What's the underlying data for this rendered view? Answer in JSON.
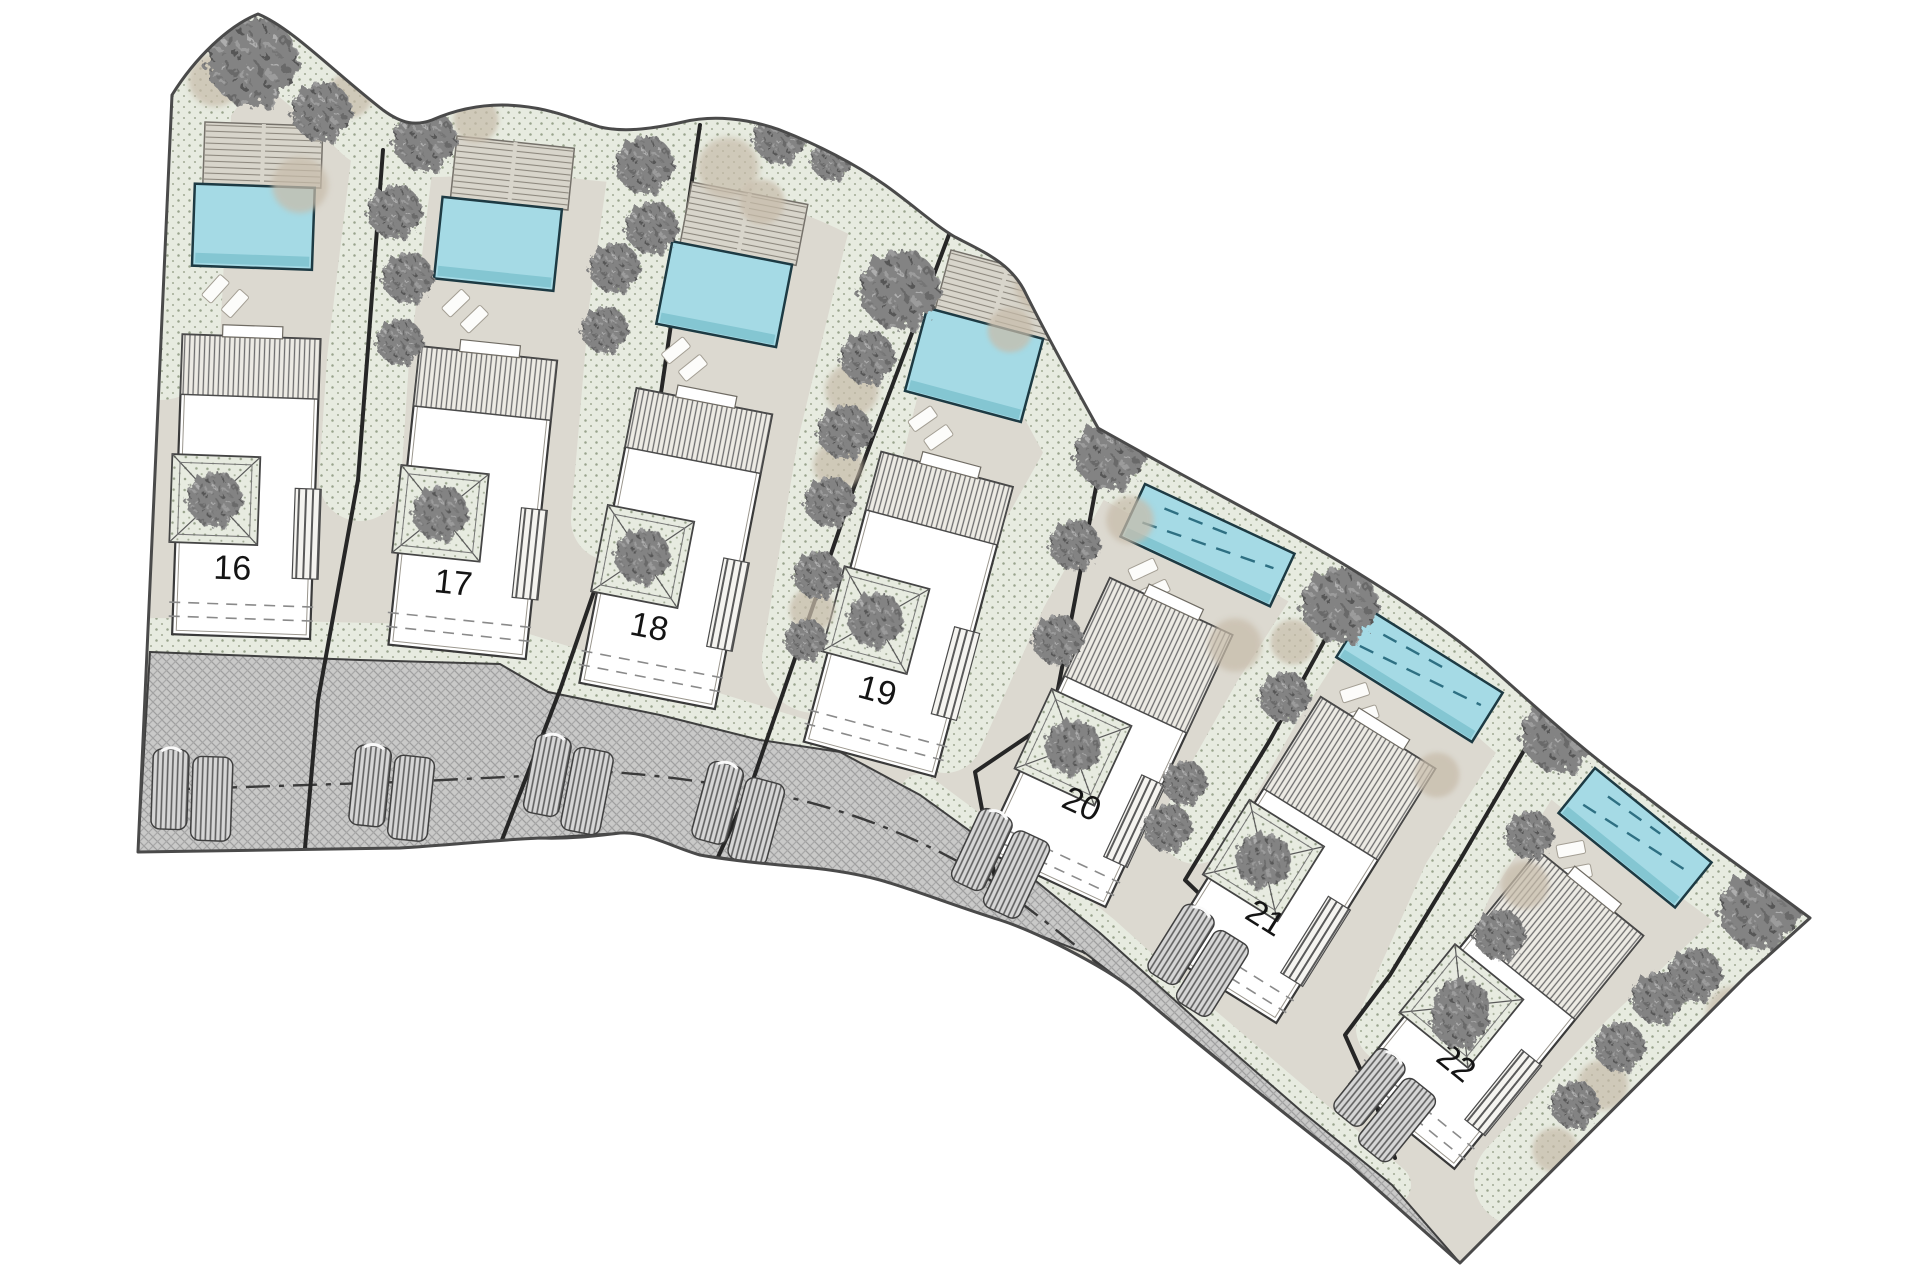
{
  "plan": {
    "type": "residential-site-plan",
    "lots": [
      {
        "number": "16"
      },
      {
        "number": "17"
      },
      {
        "number": "18"
      },
      {
        "number": "19"
      },
      {
        "number": "20"
      },
      {
        "number": "21"
      },
      {
        "number": "22"
      }
    ],
    "colors": {
      "pool_water": "#a5dae5",
      "pool_edge_shadow": "#84c6d2",
      "lot_paving": "#dcd9d0",
      "planting_bed": "#e7ebe0",
      "road_surface": "#c9c9c8",
      "tree_canopy": "#7e7e7e",
      "shrub": "#c7bcaa",
      "boundary_line": "#4a4a4a",
      "label_text": "#141414"
    },
    "symbols": {
      "tree-icon": "tree canopy",
      "shrub-icon": "shrub mass",
      "pool": "swimming pool",
      "deck": "timber deck",
      "villa": "villa footprint",
      "planter": "courtyard tree planter",
      "equipment": "driveway equipment pads",
      "road-centerline": "road centerline"
    }
  }
}
